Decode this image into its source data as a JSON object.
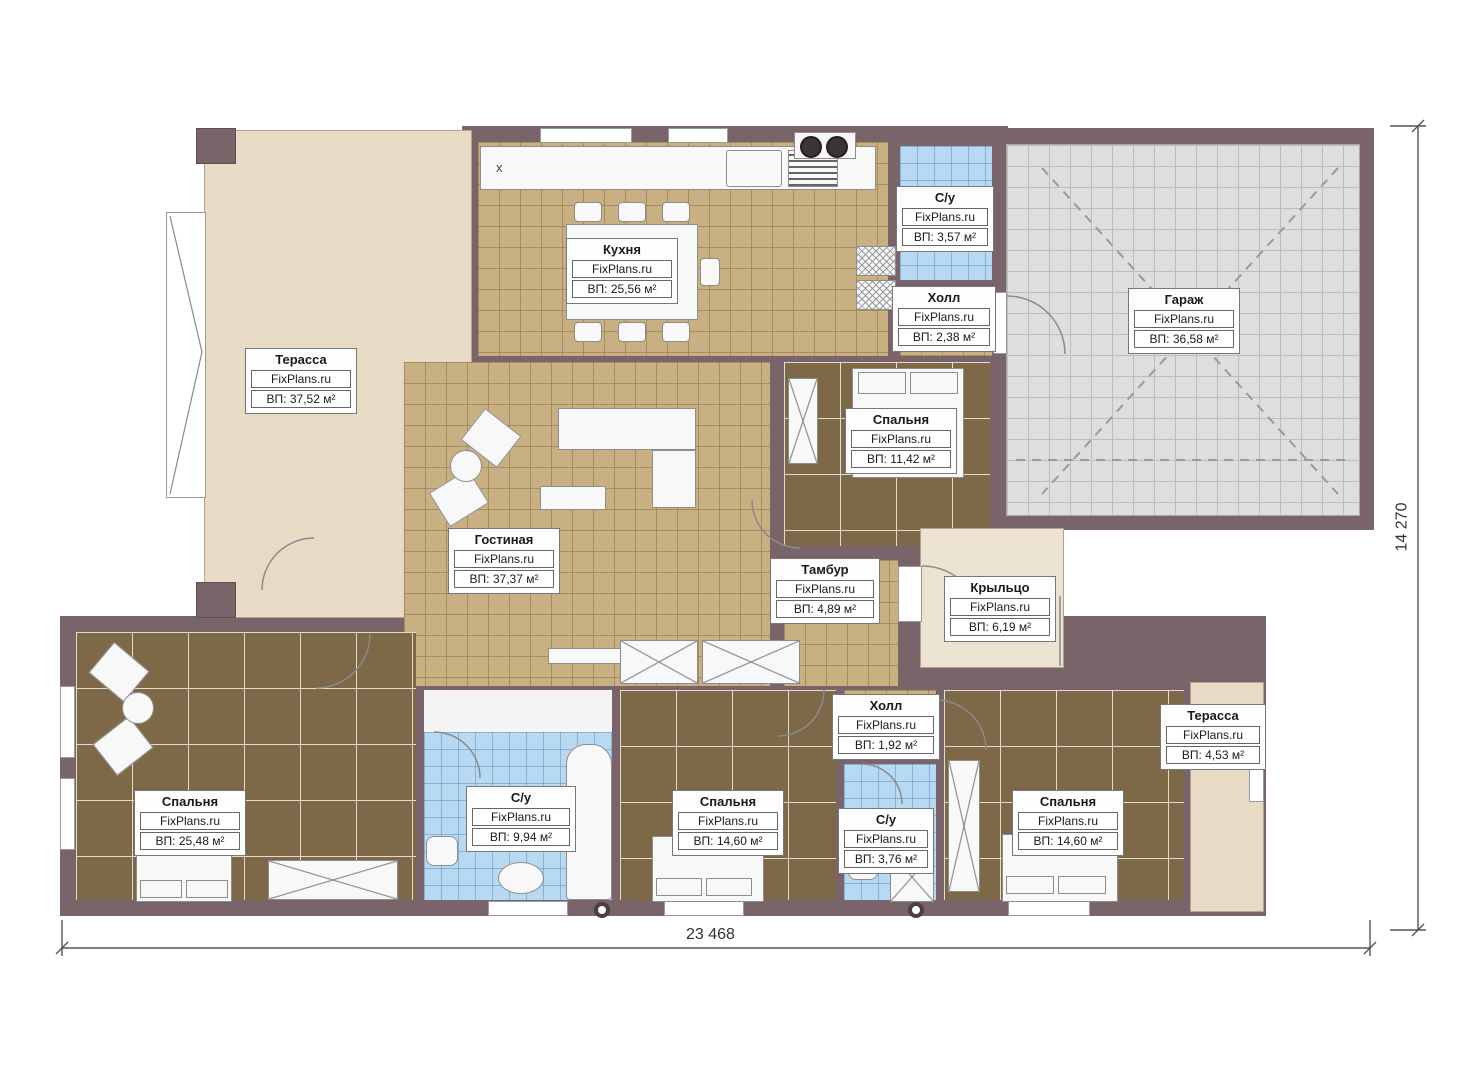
{
  "plan": {
    "title": "Floor plan",
    "brand": "FixPlans.ru",
    "dimensions": {
      "bottom": "23 468",
      "right": "14 270"
    },
    "marks": {
      "kitchen_cabinet": "x"
    },
    "rooms": [
      {
        "name": "Терасса",
        "brand": "FixPlans.ru",
        "area": "ВП: 37,52 м²"
      },
      {
        "name": "Кухня",
        "brand": "FixPlans.ru",
        "area": "ВП: 25,56 м²"
      },
      {
        "name": "С/у",
        "brand": "FixPlans.ru",
        "area": "ВП: 3,57 м²"
      },
      {
        "name": "Холл",
        "brand": "FixPlans.ru",
        "area": "ВП: 2,38 м²"
      },
      {
        "name": "Гараж",
        "brand": "FixPlans.ru",
        "area": "ВП: 36,58 м²"
      },
      {
        "name": "Спальня",
        "brand": "FixPlans.ru",
        "area": "ВП: 11,42 м²"
      },
      {
        "name": "Гостиная",
        "brand": "FixPlans.ru",
        "area": "ВП: 37,37 м²"
      },
      {
        "name": "Тамбур",
        "brand": "FixPlans.ru",
        "area": "ВП: 4,89 м²"
      },
      {
        "name": "Крыльцо",
        "brand": "FixPlans.ru",
        "area": "ВП: 6,19 м²"
      },
      {
        "name": "Спальня",
        "brand": "FixPlans.ru",
        "area": "ВП: 25,48 м²"
      },
      {
        "name": "С/у",
        "brand": "FixPlans.ru",
        "area": "ВП: 9,94 м²"
      },
      {
        "name": "Спальня",
        "brand": "FixPlans.ru",
        "area": "ВП: 14,60 м²"
      },
      {
        "name": "Холл",
        "brand": "FixPlans.ru",
        "area": "ВП: 1,92 м²"
      },
      {
        "name": "С/у",
        "brand": "FixPlans.ru",
        "area": "ВП: 3,76 м²"
      },
      {
        "name": "Спальня",
        "brand": "FixPlans.ru",
        "area": "ВП: 14,60 м²"
      },
      {
        "name": "Терасса",
        "brand": "FixPlans.ru",
        "area": "ВП: 4,53 м²"
      }
    ],
    "colors": {
      "wall": "#796569",
      "tile_tan": "#c9b083",
      "tile_brown": "#7d6947",
      "tile_gray": "#dedede",
      "tile_blue": "#b7d9f1",
      "terrace": "#e7dbc6"
    }
  }
}
